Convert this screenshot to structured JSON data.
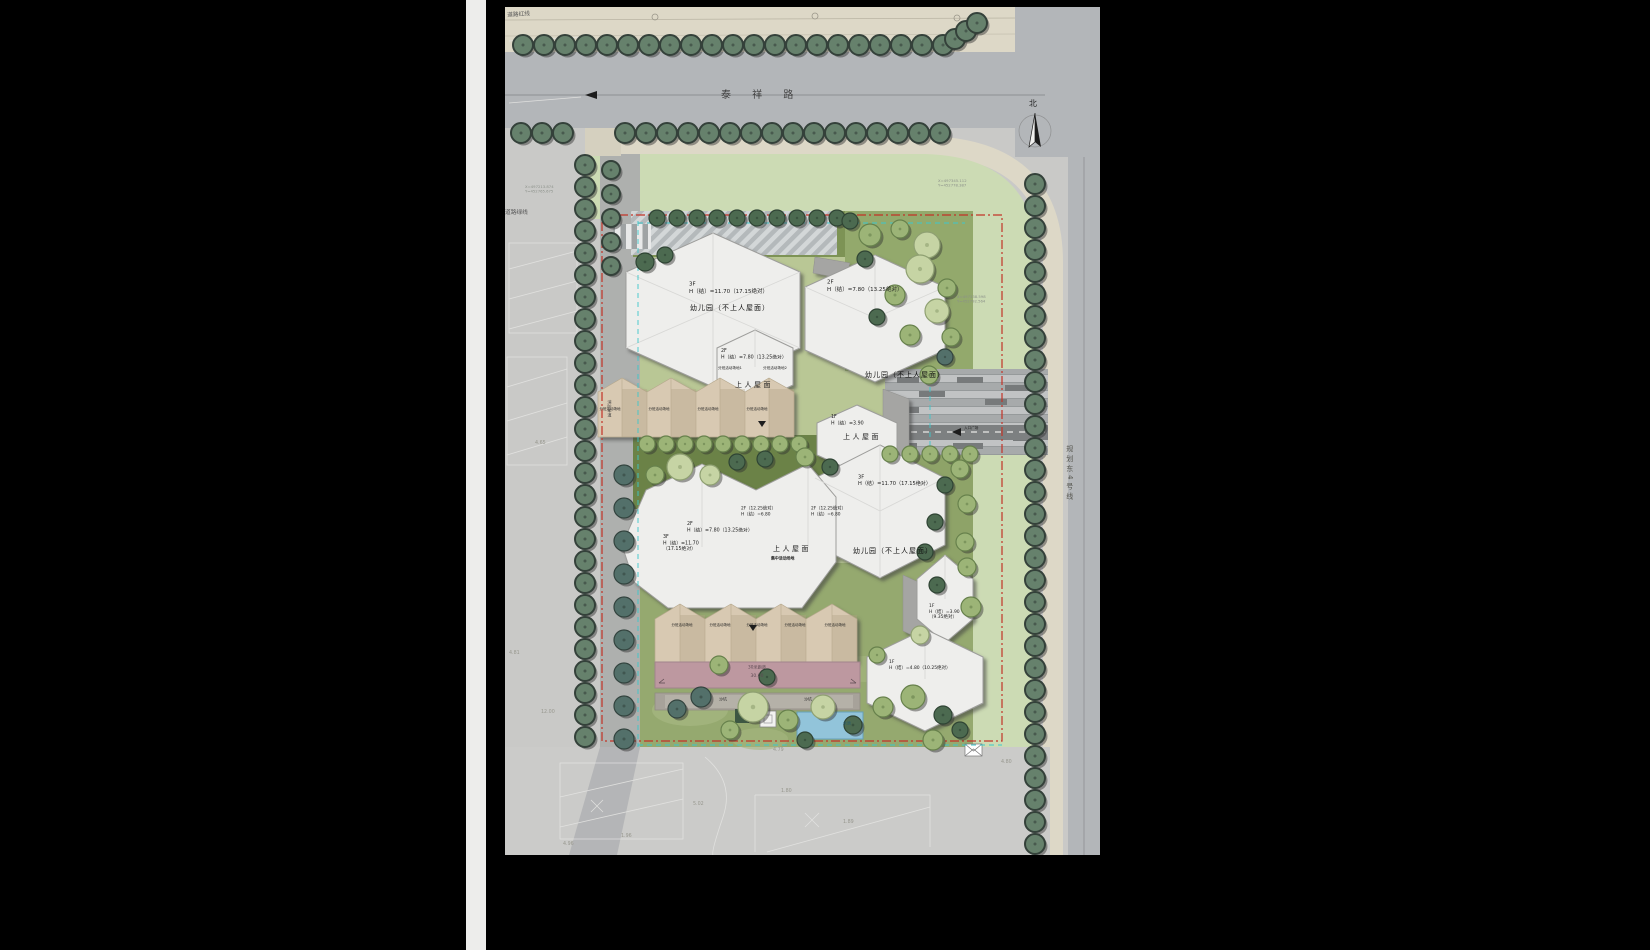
{
  "sheet": {
    "road_top": "泰 祥 路",
    "road_east": "规划东4号线",
    "north": "北",
    "redline": "道路红线",
    "greenline": "道路绿线"
  },
  "buildings": {
    "a_floors": "3F",
    "a_height": "H（结）=11.70（17.15绝对）",
    "a_name": "幼儿园（不上人屋面）",
    "b_floors": "2F",
    "b_height": "H（结）=7.80（13.25绝对）",
    "b_name": "幼儿园（不上人屋面）",
    "c_floors": "2F",
    "c_height": "H（结）=7.80（13.25绝对）",
    "c_sub1": "分班活动场地1",
    "c_sub2": "分班活动场地2",
    "c_roof": "上人屋面",
    "d_floors": "1F",
    "d_height": "H（结）=3.90",
    "d_roof": "上人屋面",
    "e_floors": "3F",
    "e_height": "H（结）=11.70（17.15绝对）",
    "e_name": "幼儿园（不上人屋面）",
    "f_line1": "2F（12.25绝对）",
    "f_line2": "H（结）=6.80",
    "f_roof": "上人屋面",
    "f_roofsub": "集中活动场地",
    "g_floors": "2F",
    "g_height": "H（结）=7.80（13.25绝对）",
    "h_floors": "3F",
    "h_height1": "H（结）=11.70",
    "h_height2": "（17.15绝对）",
    "i_floors": "1F",
    "i_height1": "H（结）=3.90",
    "i_height2": "（9.35绝对）",
    "j_floors": "1F",
    "j_height": "H（结）=4.80（10.25绝对）"
  },
  "site": {
    "track": "30米跑道",
    "track_dim": "30.00",
    "sand": "沙坑",
    "pool": "水池",
    "fire_lane": "消防车道",
    "entry": "入口广场",
    "class_ground": "分班活动场地",
    "class_ground_1": "分班活动场地1",
    "class_ground_2": "分班活动场地2"
  },
  "survey": {
    "spots": [
      "4.65",
      "4.81",
      "12.00",
      "4.79",
      "1.80",
      "1.89",
      "5.02",
      "1.96",
      "4.96",
      "4.80"
    ]
  },
  "coords": {
    "c1x": "X=497345.112",
    "c1y": "Y=452778.387",
    "c2x": "X=497338.598",
    "c2y": "Y=452792.564",
    "c3x": "X=497213.874",
    "c3y": "Y=452765.675"
  },
  "colors": {
    "boundary_red": "#c33327",
    "guide_cyan": "#3cc7cb",
    "roof_white": "#eeeeec",
    "activity_tan": "#d8c9b2",
    "track_pink": "#bd98a0",
    "pool_blue": "#92c4da",
    "lawn_green": "#6b8247",
    "verge_green": "#ccdbb4",
    "asphalt_gray": "#b3b6b9"
  }
}
